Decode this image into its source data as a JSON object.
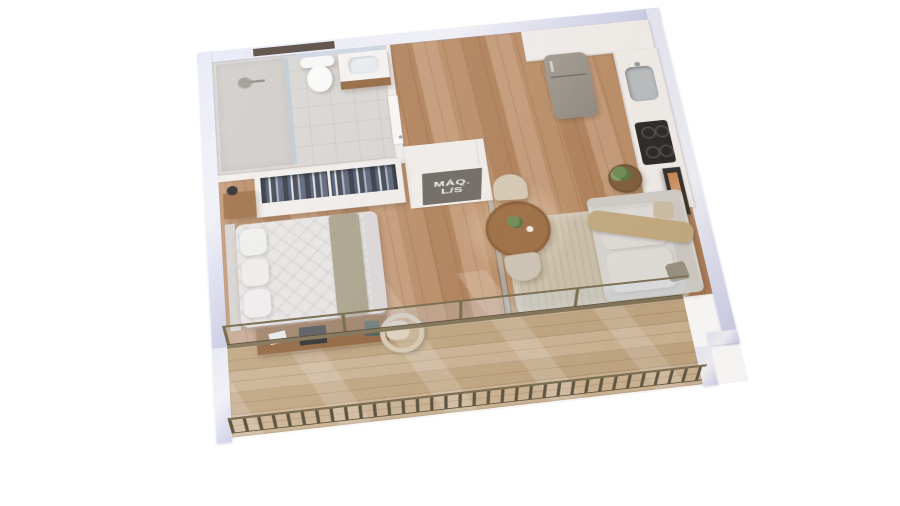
{
  "scene": {
    "kind": "3d-isometric-floorplan-render",
    "description": "studio apartment 3D floor plan on white background"
  },
  "label_plate": {
    "line1": "MÁQ.",
    "line2": "L/S"
  },
  "palette": {
    "bg": "#ffffff",
    "wallCut": "#e6e9f7",
    "wallCutEdge": "#c9cde9",
    "wallWhite": "#f3f0ed",
    "wood1": "#c59a76",
    "wood2": "#ba8c64",
    "wood3": "#b07f57",
    "deck1": "#ccb392",
    "deck2": "#c0a57f",
    "bathFloor": "#d9d6d3",
    "rug": "#cdc2ac",
    "sofa": "#dad8d4",
    "throw": "#c3aa7e",
    "duvet": "#e9e7e6",
    "runner": "#a9a28b",
    "tableWood": "#9c6b3f",
    "deskWood": "#8f6239",
    "chairBeige": "#d8cbb5",
    "fridge": "#a19b93",
    "cooktop": "#23211f",
    "railing": "#7d6f52",
    "railingDark": "#5f5540",
    "artOrange": "#c8834f",
    "plateGray": "#75706a",
    "labelWhite": "#f4f2ef",
    "plantGreen": "#6d8a52"
  },
  "objects": [
    "shower",
    "toilet",
    "vanity-sink",
    "mirror",
    "bathroom-door",
    "fridge",
    "kitchen-cabinets",
    "kitchen-sink",
    "cooktop",
    "washer-dryer-closet",
    "wardrobe",
    "bed",
    "nightstand",
    "wall-lamp",
    "desk",
    "laptop",
    "desk-chair",
    "dining-table",
    "dining-chairs",
    "sofa",
    "side-table",
    "plant",
    "art-frame",
    "rug",
    "balcony-deck",
    "balcony-railing",
    "glass-sliding-doors"
  ]
}
